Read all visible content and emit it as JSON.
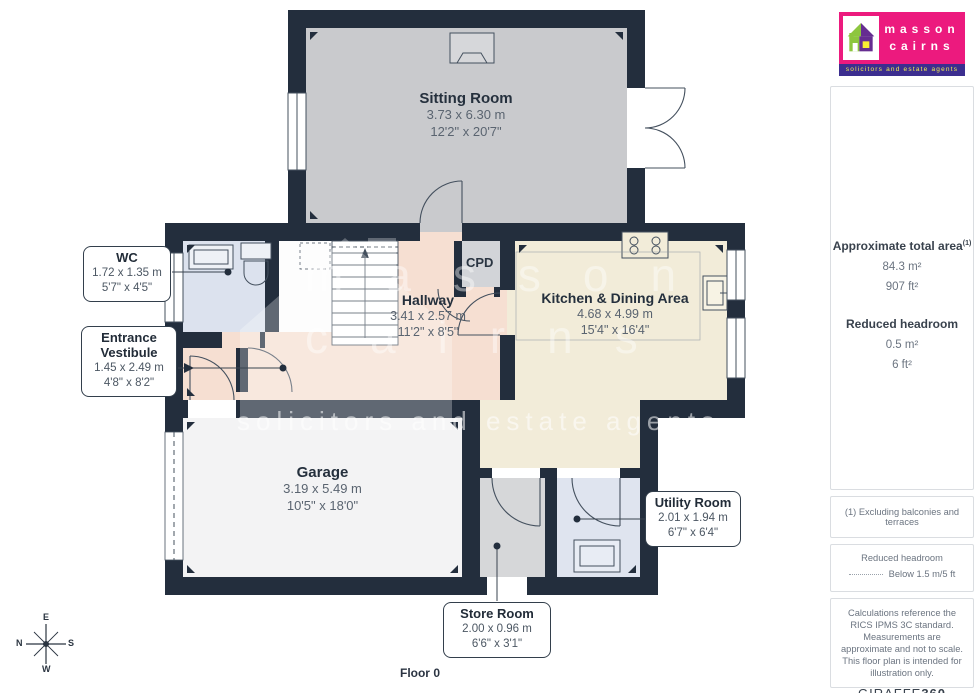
{
  "logo": {
    "name_line1": "masson",
    "name_line2": "cairns",
    "tagline": "solicitors and estate agents"
  },
  "watermark": {
    "line1": "masson",
    "line2": "cairns",
    "tagline": "solicitors and estate agents"
  },
  "sidebar": {
    "total_area_label": "Approximate total area",
    "total_area_superscript": "(1)",
    "total_area_m2": "84.3 m²",
    "total_area_ft2": "907 ft²",
    "reduced_headroom_label": "Reduced headroom",
    "reduced_headroom_m2": "0.5 m²",
    "reduced_headroom_ft2": "6 ft²",
    "footnote": "(1) Excluding balconies and terraces",
    "legend_title": "Reduced headroom",
    "legend_value": "Below 1.5 m/5 ft",
    "disclaimer": "Calculations reference the RICS IPMS 3C standard. Measurements are approximate and not to scale. This floor plan is intended for illustration only.",
    "brand": "GIRAFFE",
    "brand_bold": "360"
  },
  "plan": {
    "floor_label": "Floor 0"
  },
  "compass": {
    "top": "E",
    "right": "S",
    "bottom": "W",
    "left": "N"
  },
  "rooms": [
    {
      "label": "Sitting Room",
      "metric": "3.73 x 6.30 m",
      "imperial": "12'2\" x 20'7\""
    },
    {
      "label": "WC",
      "metric": "1.72 x 1.35 m",
      "imperial": "5'7\" x 4'5\""
    },
    {
      "label": "Entrance Vestibule",
      "metric": "1.45 x 2.49 m",
      "imperial": "4'8\" x 8'2\""
    },
    {
      "label": "Hallway",
      "metric": "3.41 x 2.57 m",
      "imperial": "11'2\" x 8'5\""
    },
    {
      "label": "Kitchen & Dining Area",
      "metric": "4.68 x 4.99 m",
      "imperial": "15'4\" x 16'4\""
    },
    {
      "label": "CPD"
    },
    {
      "label": "Garage",
      "metric": "3.19 x 5.49 m",
      "imperial": "10'5\" x 18'0\""
    },
    {
      "label": "Utility Room",
      "metric": "2.01 x 1.94 m",
      "imperial": "6'7\" x 6'4\""
    },
    {
      "label": "Store Room",
      "metric": "2.00 x 0.96 m",
      "imperial": "6'6\" x 3'1\""
    }
  ],
  "colors": {
    "wall": "#232e3d",
    "sitting_room_floor": "#c9cacd",
    "wc_floor": "#dce2ee",
    "hallway_floor": "#f6dfd2",
    "kitchen_floor": "#f2ecd9",
    "garage_floor": "#f3f3f4",
    "store_floor": "#d6d7d9",
    "utility_floor": "#dfe4ef",
    "cpd_floor": "#d2d4d8",
    "logo_pink": "#ec1a7e",
    "logo_purple": "#3c2e8f",
    "logo_green": "#8dc63f",
    "logo_violet": "#662d91",
    "logo_yellow": "#f9ed32"
  }
}
